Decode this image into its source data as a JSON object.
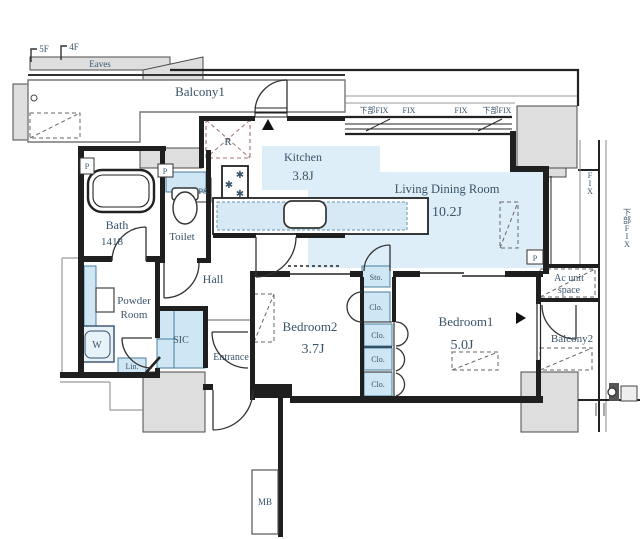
{
  "plan": {
    "floors": {
      "upper": "5F",
      "lower": "4F"
    },
    "eaves": "Eaves",
    "balcony1": "Balcony1",
    "balcony2": "Balcony2",
    "kitchen": {
      "name": "Kitchen",
      "size": "3.8J"
    },
    "living": {
      "name": "Living Dining Room",
      "size": "10.2J"
    },
    "bath": {
      "name": "Bath",
      "size": "1418"
    },
    "toilet": "Toilet",
    "hall": "Hall",
    "powder": {
      "line1": "Powder",
      "line2": "Room"
    },
    "washer": "W",
    "linen": "Lin.",
    "sic": "SIC",
    "entrance": "Entrance",
    "storage": "Sto.",
    "closet": "Clo.",
    "bedroom1": {
      "name": "Bedroom1",
      "size": "5.0J"
    },
    "bedroom2": {
      "name": "Bedroom2",
      "size": "3.7J"
    },
    "ac_space": {
      "line1": "Ac unit",
      "line2": "space"
    },
    "meter_box": "MB",
    "refrigerator": "R",
    "pipe_shaft": "PS",
    "pipe": "P",
    "window_fix": "FIX",
    "window_fix_lower": "下部FIX"
  },
  "icons": {
    "burner": "✱"
  },
  "colors": {
    "room_tint": "#ddeef8",
    "fixture_blue": "#cfe6f4",
    "fixture_border": "#4a7f9e",
    "label_text": "#3a5468",
    "wall": "#1f1f1f",
    "structure_gray": "#dedede",
    "refrigerator_mark": "#a07070"
  }
}
